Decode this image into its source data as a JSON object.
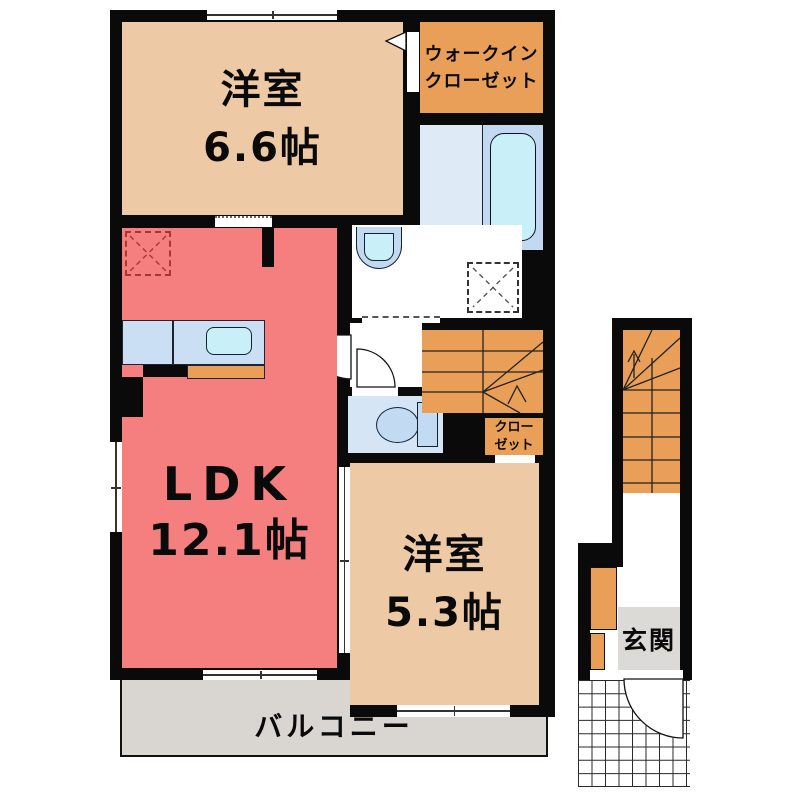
{
  "rooms": {
    "western1": {
      "name": "洋室",
      "size": "6.6帖"
    },
    "wic": {
      "line1": "ウォークイン",
      "line2": "クローゼット"
    },
    "ldk": {
      "name": "LDK",
      "size": "12.1帖"
    },
    "western2": {
      "name": "洋室",
      "size": "5.3帖"
    },
    "closet": {
      "line1": "クロー",
      "line2": "ゼット"
    },
    "balcony": {
      "name": "バルコニー"
    },
    "entrance": {
      "name": "玄関"
    }
  },
  "colors": {
    "wall": "#0a0a0a",
    "room_beige": "#EDC9A6",
    "accent_orange": "#E99F58",
    "ldk_salmon": "#F57E7E",
    "bath_floor": "#DFEAF7",
    "fixture_blue": "#C2D9F1",
    "water_cyan": "#C9EFF9",
    "toilet_room": "#D5E5F6",
    "toilet_fixture": "#C3DAF3",
    "counter_blue": "#CADEF4",
    "balcony_gray": "#D9D5D0",
    "entrance_gray": "#DCDAD6",
    "fridge_dash": "#A5382F"
  }
}
